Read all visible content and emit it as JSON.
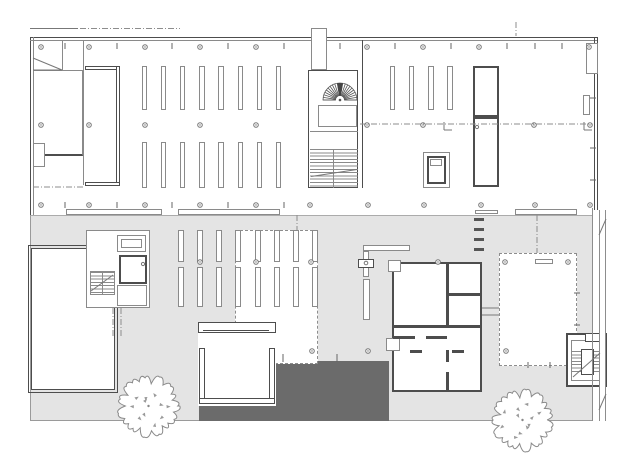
{
  "document": {
    "kind": "architectural-floor-plan",
    "visible_text": ""
  },
  "palette": {
    "paper": "#ffffff",
    "wall_line": "#4d4d4d",
    "light_line": "#8a8a8a",
    "plaza_fill": "#e4e4e4",
    "courtyard_fill": "#6b6b6b",
    "marker_line": "#777777"
  },
  "plan": {
    "shelf_groups": [
      {
        "name": "upper-left-stacks",
        "rows": 2,
        "cols": 8
      },
      {
        "name": "upper-right-stacks",
        "rows": 1,
        "cols": 4
      },
      {
        "name": "lower-stacks",
        "rows": 2,
        "cols": 8
      }
    ],
    "stairs": [
      "spiral-stair",
      "main-stair",
      "west-stair",
      "east-stair"
    ],
    "elevators": 1,
    "trees": 2,
    "column_marker_rows": [
      47,
      125,
      205,
      262,
      351
    ]
  }
}
